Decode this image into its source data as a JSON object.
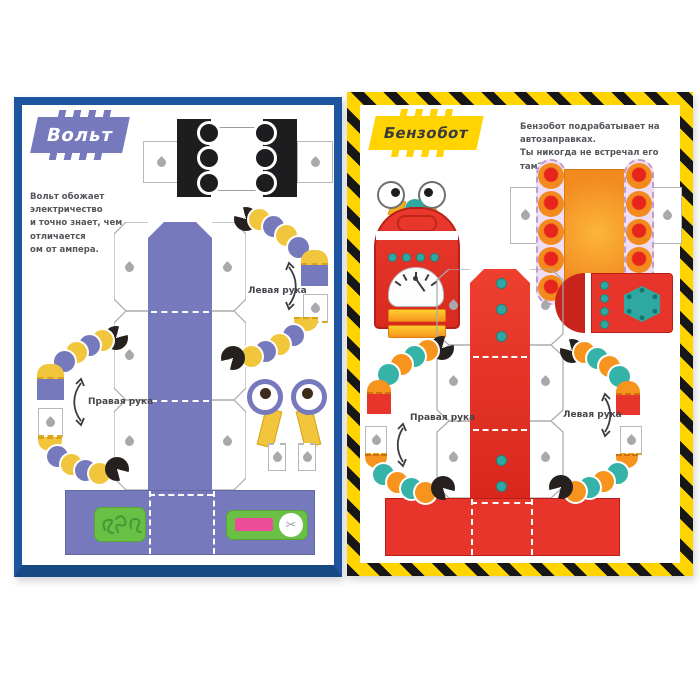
{
  "left_page": {
    "title": "Вольт",
    "description": "Вольт обожает электричество\nи точно знает, чем отличается\nом от ампера.",
    "left_arm_label": "Левая рука",
    "right_arm_label": "Правая рука"
  },
  "right_page": {
    "title": "Бензобот",
    "description": "Бензобот подрабатывает на автозаправках.\nТы никогда не встречал его там?",
    "left_arm_label": "Левая рука",
    "right_arm_label": "Правая рука"
  },
  "icons": {
    "scissors": "✂"
  },
  "colors": {
    "left_border_blue": "#1e55a1",
    "left_accent_purple": "#767abd",
    "bead_yellow": "#f2c63c",
    "right_border_yellow": "#ffd400",
    "right_accent_red": "#e8352b",
    "bead_teal": "#35b3a9",
    "bead_orange": "#f7941e",
    "sticker_green": "#6abf45",
    "sticker_pink": "#ee4d9b"
  }
}
